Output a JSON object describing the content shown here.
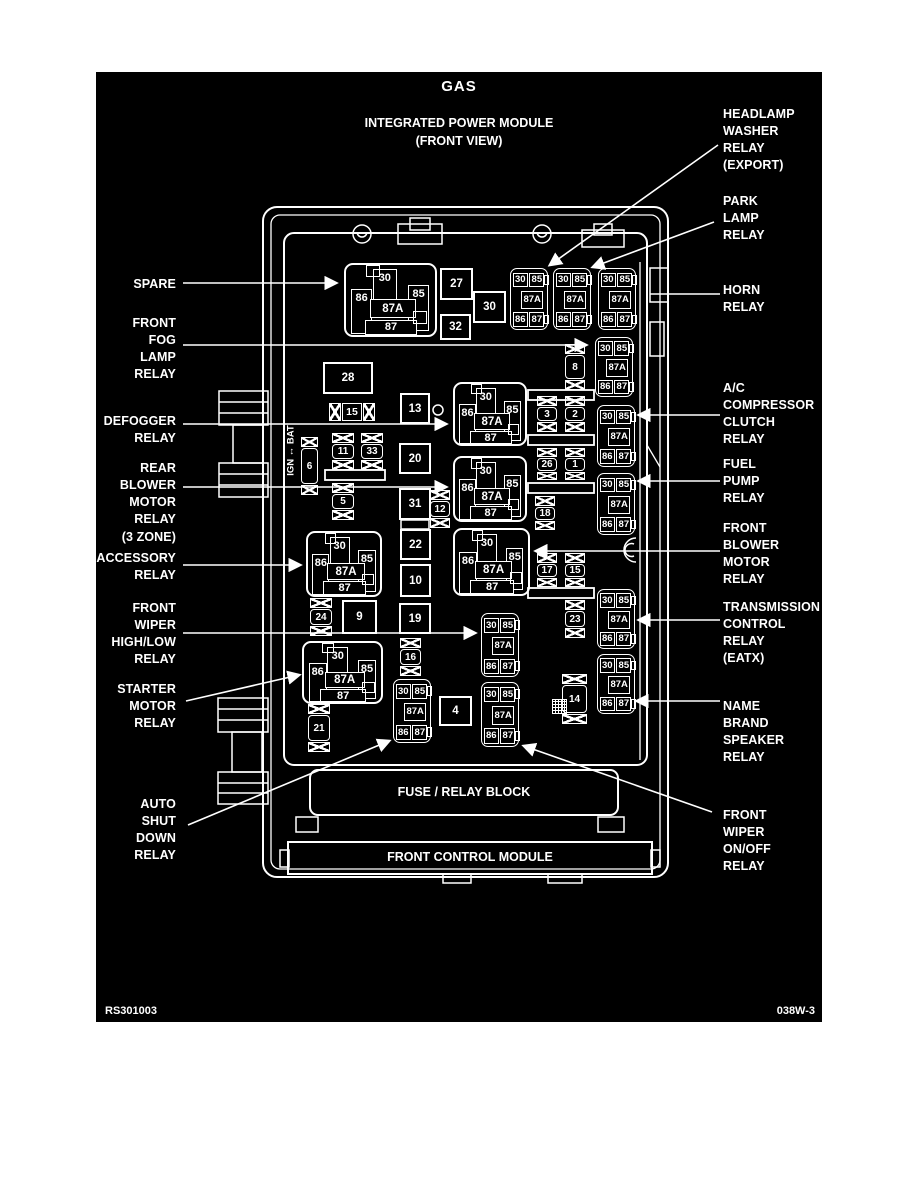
{
  "page": {
    "footer_left": "RS301003",
    "footer_right": "038W-3"
  },
  "titles": {
    "fuel_type": "GAS",
    "main": "INTEGRATED POWER MODULE\n(FRONT VIEW)",
    "block": "FUSE / RELAY BLOCK",
    "module": "FRONT CONTROL MODULE",
    "ign_bat": "IGN ↔ BAT"
  },
  "relay_pads": {
    "p30": "30",
    "p85": "85",
    "p86": "86",
    "p87a": "87A",
    "p87": "87"
  },
  "labels_left": [
    {
      "text": "SPARE"
    },
    {
      "text": "FRONT\nFOG\nLAMP\nRELAY"
    },
    {
      "text": "DEFOGGER\nRELAY"
    },
    {
      "text": "REAR\nBLOWER\nMOTOR\nRELAY\n(3 ZONE)"
    },
    {
      "text": "ACCESSORY\nRELAY"
    },
    {
      "text": "FRONT\nWIPER\nHIGH/LOW\nRELAY"
    },
    {
      "text": "STARTER\nMOTOR\nRELAY"
    },
    {
      "text": "AUTO\nSHUT\nDOWN\nRELAY"
    }
  ],
  "labels_right": [
    {
      "text": "HEADLAMP\nWASHER\nRELAY\n(EXPORT)"
    },
    {
      "text": "PARK\nLAMP\nRELAY"
    },
    {
      "text": "HORN\nRELAY"
    },
    {
      "text": "A/C\nCOMPRESSOR\nCLUTCH\nRELAY"
    },
    {
      "text": "FUEL\nPUMP\nRELAY"
    },
    {
      "text": "FRONT\nBLOWER\nMOTOR\nRELAY"
    },
    {
      "text": "TRANSMISSION\nCONTROL\nRELAY\n(EATX)"
    },
    {
      "text": "NAME\nBRAND\nSPEAKER\nRELAY"
    },
    {
      "text": "FRONT\nWIPER\nON/OFF\nRELAY"
    }
  ],
  "fuses": {
    "f27": "27",
    "f30": "30",
    "f32": "32",
    "f28": "28",
    "f15h": "15",
    "f13": "13",
    "f20": "20",
    "f31": "31",
    "f22": "22",
    "f10": "10",
    "f19": "19",
    "f9": "9",
    "f4": "4",
    "f11": "11",
    "f33": "33",
    "f5": "5",
    "f6": "6",
    "f12": "12",
    "f24": "24",
    "f16": "16",
    "f21": "21",
    "f3": "3",
    "f2": "2",
    "f26": "26",
    "f1": "1",
    "f18": "18",
    "f8": "8",
    "f17": "17",
    "f15": "15",
    "f23": "23",
    "f14": "14"
  }
}
